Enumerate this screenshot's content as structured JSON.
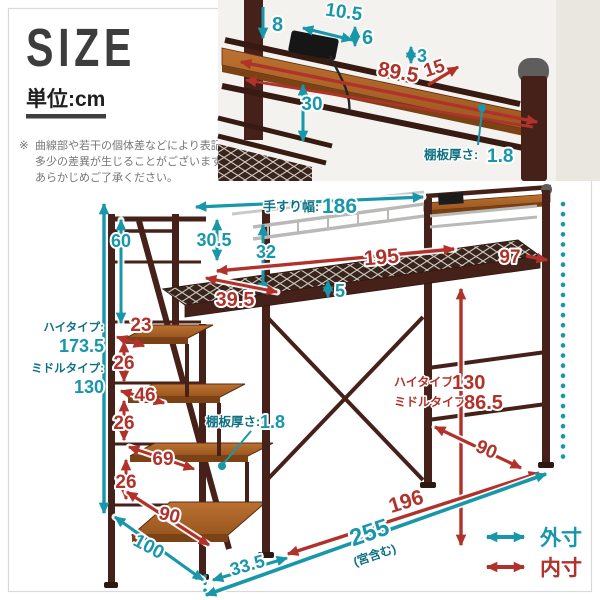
{
  "header": {
    "title": "SIZE",
    "unit": "単位:cm",
    "note_mark": "※",
    "note1": "曲線部や若干の個体差などにより表記と",
    "note2": "多少の差異が生じることがございます。",
    "note3": "あらかじめご了承ください。"
  },
  "legend": {
    "outer": "外寸",
    "inner": "内寸"
  },
  "colors": {
    "outer_teal": "#1897ab",
    "inner_red": "#b1322a",
    "frame_brown": "#46211a",
    "wood": "#a55e22"
  },
  "closeup": {
    "top_drop": "8",
    "outlet_width": "10.5",
    "lip": "6",
    "clearance": "3",
    "shelf_depth": "15",
    "shelf_width": "89.5",
    "rail_drop": "30",
    "thickness_label": "棚板厚さ:",
    "thickness": "1.8"
  },
  "diagram": {
    "handrail_label": "手すり幅:",
    "handrail_width": "186",
    "top_to_step": "60",
    "guard1": "30.5",
    "guard2": "32",
    "landing_depth": "39.5",
    "inner_length": "195",
    "head_width": "97",
    "frame_height": "5",
    "step1": "23",
    "riser1": "26",
    "step2": "46",
    "riser2": "26",
    "step3": "69",
    "riser3": "26",
    "step4": "90",
    "high_label": "ハイタイプ:",
    "high_height": "173.5",
    "middle_label": "ミドルタイプ:",
    "middle_height": "130",
    "thickness_label": "棚板厚さ:",
    "thickness": "1.8",
    "under_high_label": "ハイタイプ:",
    "under_high": "130",
    "under_middle_label": "ミドルタイプ:",
    "under_middle": "86.5",
    "bed_depth": "90",
    "stairs_depth": "100",
    "stairs_offset": "33.5",
    "total_inner": "196",
    "total_outer": "255",
    "total_outer_note": "(宮含む)"
  }
}
